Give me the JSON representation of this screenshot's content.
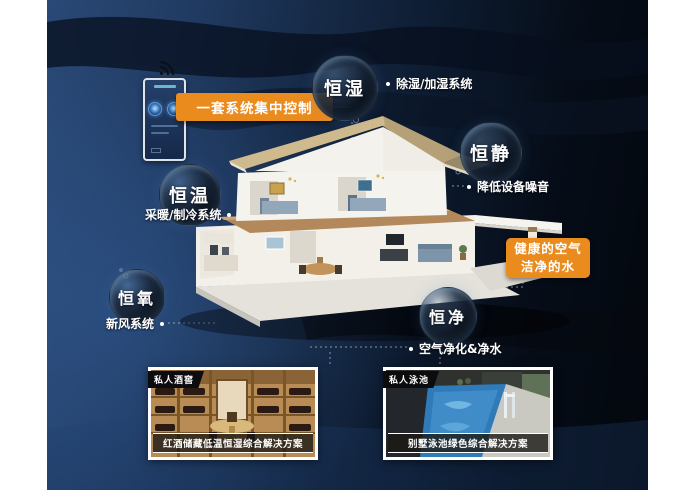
{
  "poster": {
    "accent_color": "#ea8b1e",
    "background_color": "#16283f"
  },
  "control_panel": {
    "label": "一套系统集中控制"
  },
  "bubbles": [
    {
      "label": "恒湿",
      "note": "除湿/加湿系统"
    },
    {
      "label": "恒静",
      "note": "降低设备噪音"
    },
    {
      "label": "恒温",
      "note": "采暖/制冷系统"
    },
    {
      "label": "恒氧",
      "note": "新风系统"
    },
    {
      "label": "恒净",
      "note": "空气净化&净水"
    }
  ],
  "callout": {
    "line1": "健康的空气",
    "line2": "洁净的水"
  },
  "cards": [
    {
      "tag": "私人酒窖",
      "caption": "红酒储藏低温恒湿综合解决方案"
    },
    {
      "tag": "私人泳池",
      "caption": "别墅泳池绿色综合解决方案"
    }
  ]
}
